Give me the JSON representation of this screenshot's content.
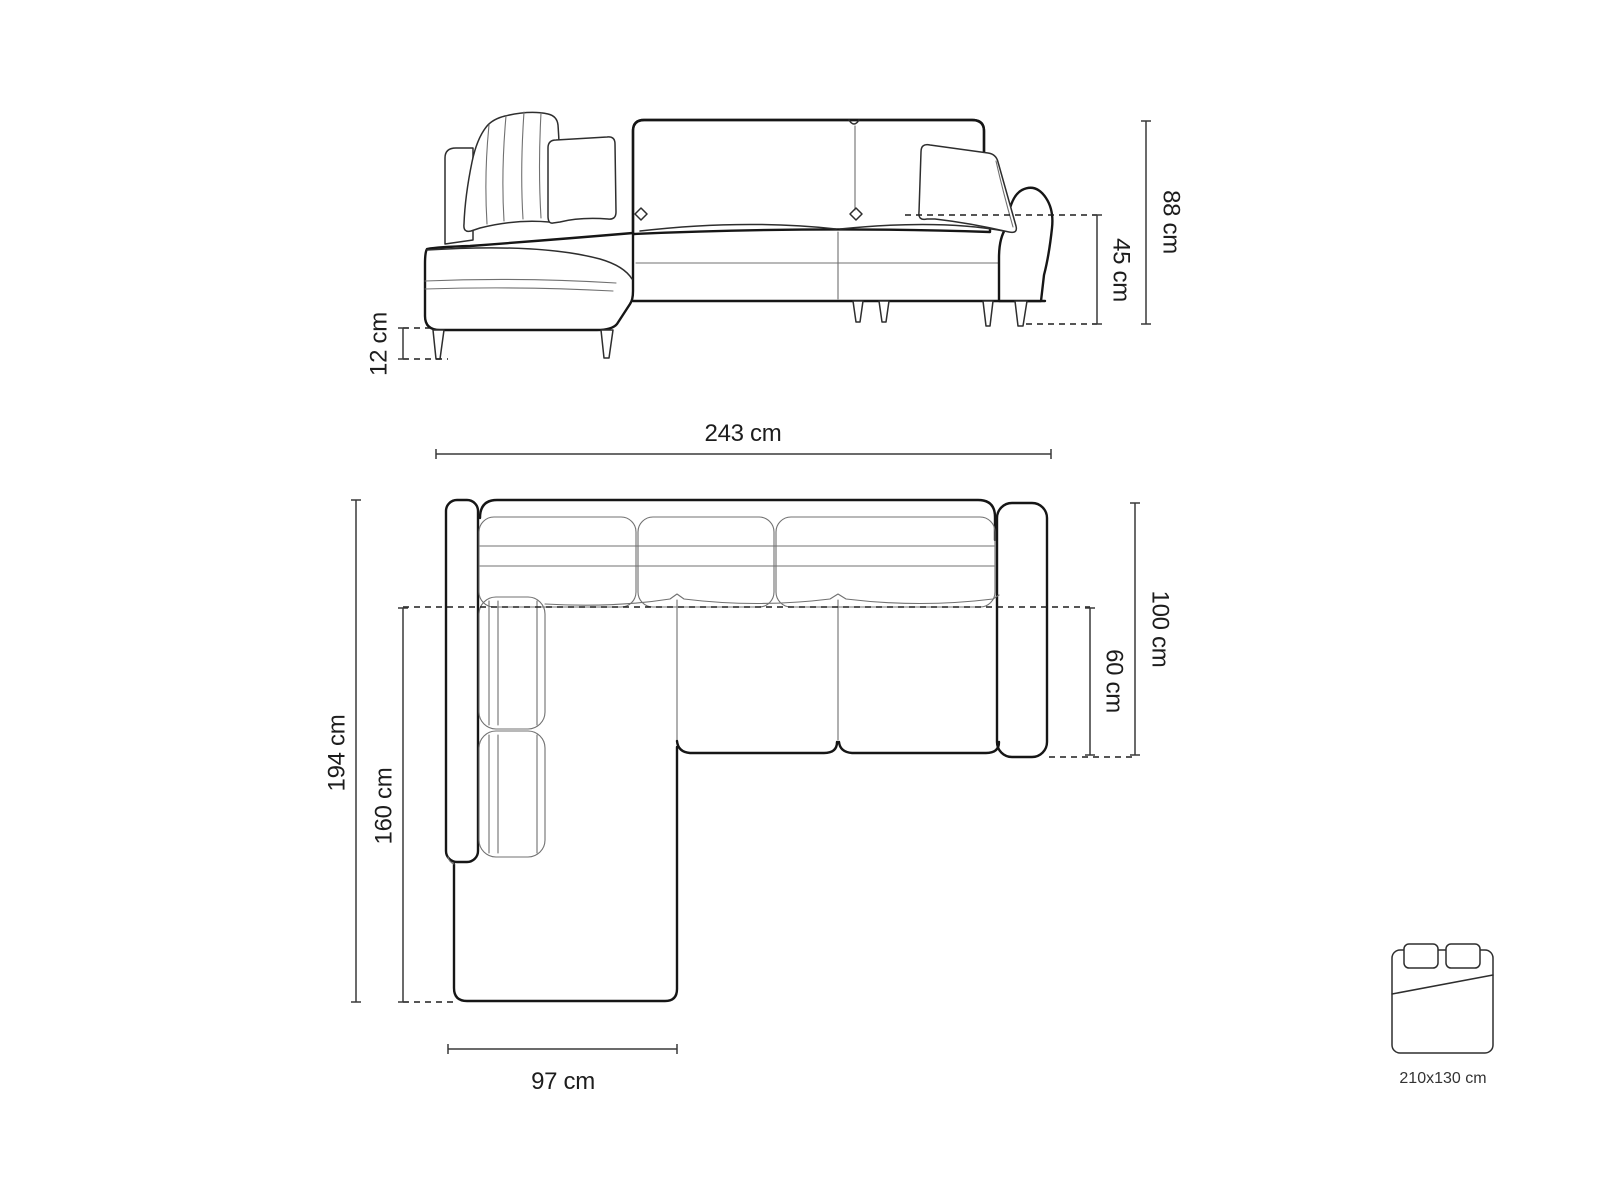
{
  "diagram": {
    "dimensions": {
      "total_height": "88 cm",
      "seat_height": "45 cm",
      "leg_height": "12 cm",
      "total_width": "243 cm",
      "total_depth": "194 cm",
      "chaise_depth": "160 cm",
      "chaise_width": "97 cm",
      "body_depth": "100 cm",
      "seat_depth": "60 cm",
      "bed_size": "210x130 cm"
    },
    "icons": {
      "side_view": "sofa-side-elevation",
      "plan_view": "sofa-top-plan",
      "bed": "sleeping-area-icon"
    },
    "colors": {
      "background": "#ffffff",
      "outline": "#161616",
      "thin_line": "#707070",
      "dimension_line": "#3a3a3a"
    }
  }
}
